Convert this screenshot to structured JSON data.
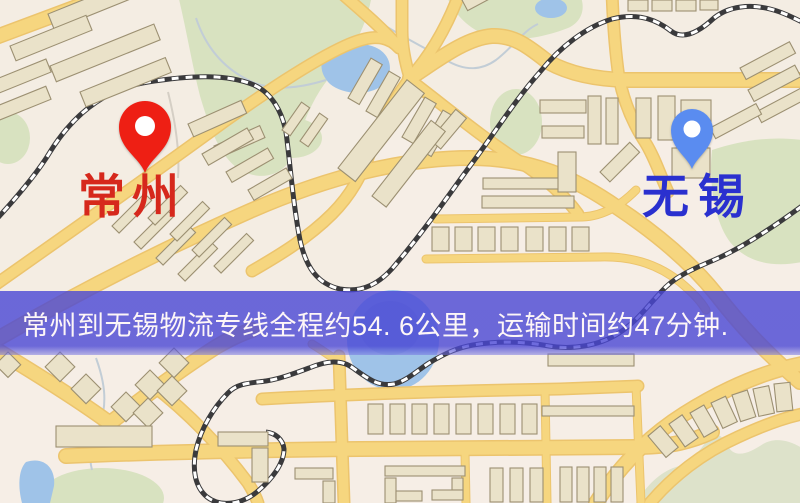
{
  "map": {
    "origin": {
      "label": "常州"
    },
    "destination": {
      "label": "无锡"
    }
  },
  "banner": {
    "text": "常州到无锡物流专线全程约54. 6公里，运输时间约47分钟."
  },
  "colors": {
    "pin-red": "#ee1f14",
    "pin-blue": "#5a8cf0",
    "label-red": "#d6281c",
    "label-blue": "#2a30cf",
    "banner-overlay": "rgba(73,70,213,0.80)",
    "banner-text": "#fdf6f7",
    "map-bg": "#f4ede3",
    "road-fill": "#f6d67f",
    "road-casing": "#ecc46d",
    "railway-dark": "#3a3a3c",
    "railway-light": "#ffffff",
    "building-fill": "#eae2c9",
    "building-stroke": "#9c9072",
    "water": "#9fc3e8",
    "park": "#d8e2c0",
    "hill": "#dde2ca",
    "stream": "#c2cdd6"
  }
}
